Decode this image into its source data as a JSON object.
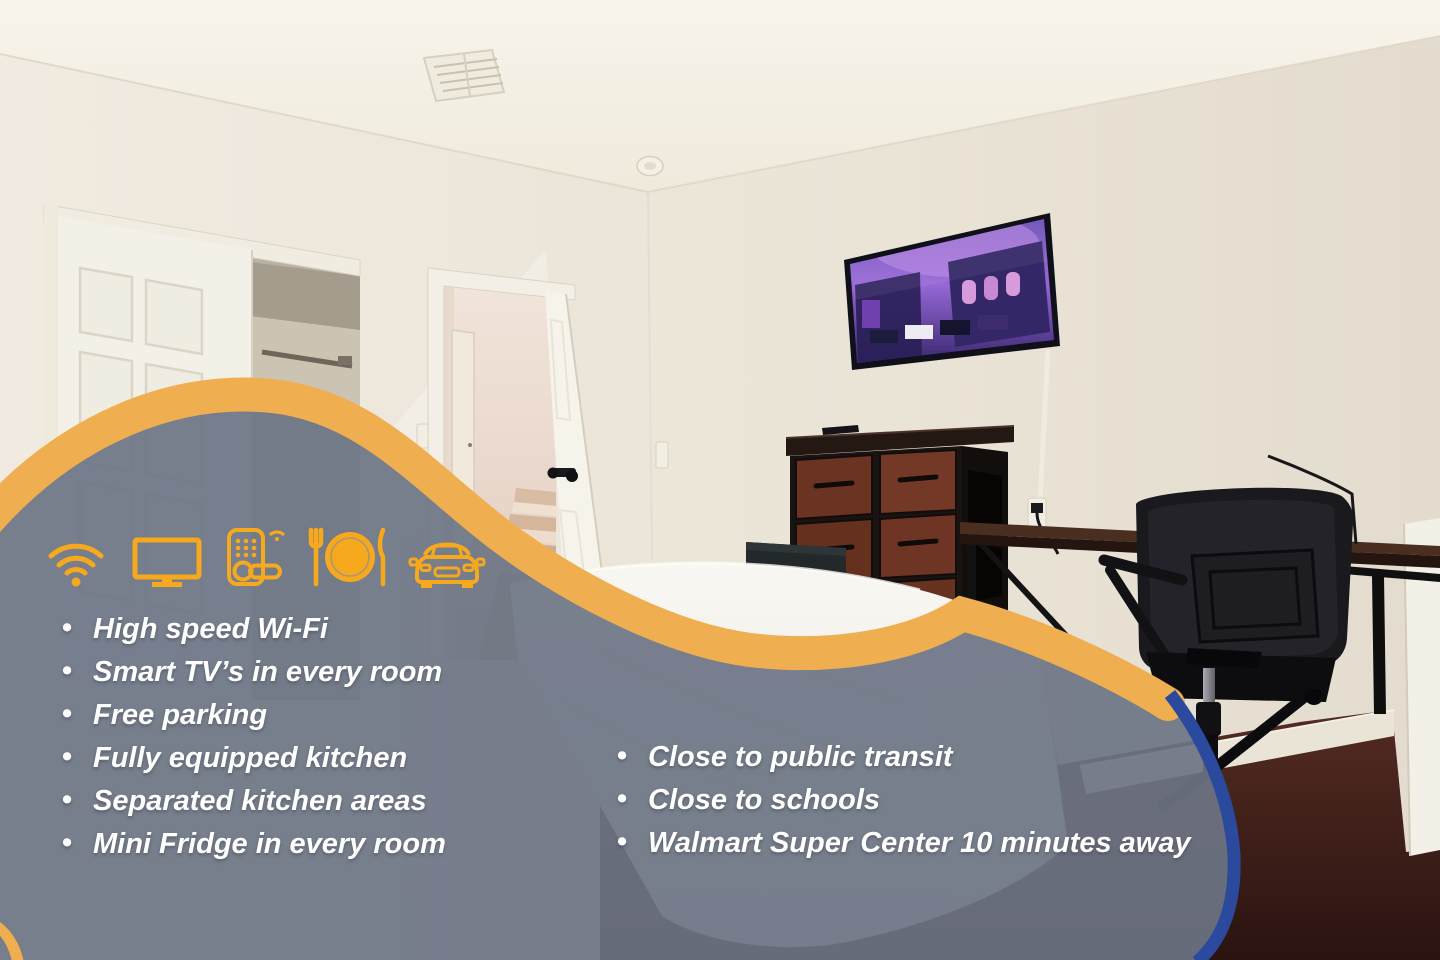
{
  "listing_overlay": {
    "amenities_left": [
      "High speed Wi-Fi",
      "Smart TV’s in every room",
      "Free parking",
      "Fully equipped kitchen",
      "Separated kitchen areas",
      "Mini Fridge in every room"
    ],
    "amenities_right": [
      "Close to public transit",
      "Close to schools",
      "Walmart Super Center 10 minutes away"
    ],
    "icons": [
      "wifi-icon",
      "smart-tv-icon",
      "smart-lock-icon",
      "dining-icon",
      "car-icon"
    ],
    "colors": {
      "accent_gold": "#F7A91E",
      "band_gold": "#EFAE4F",
      "panel_gray": "#6D7484",
      "edge_blue": "#2B4A9D",
      "bullet_text": "#FFFFFF"
    }
  }
}
